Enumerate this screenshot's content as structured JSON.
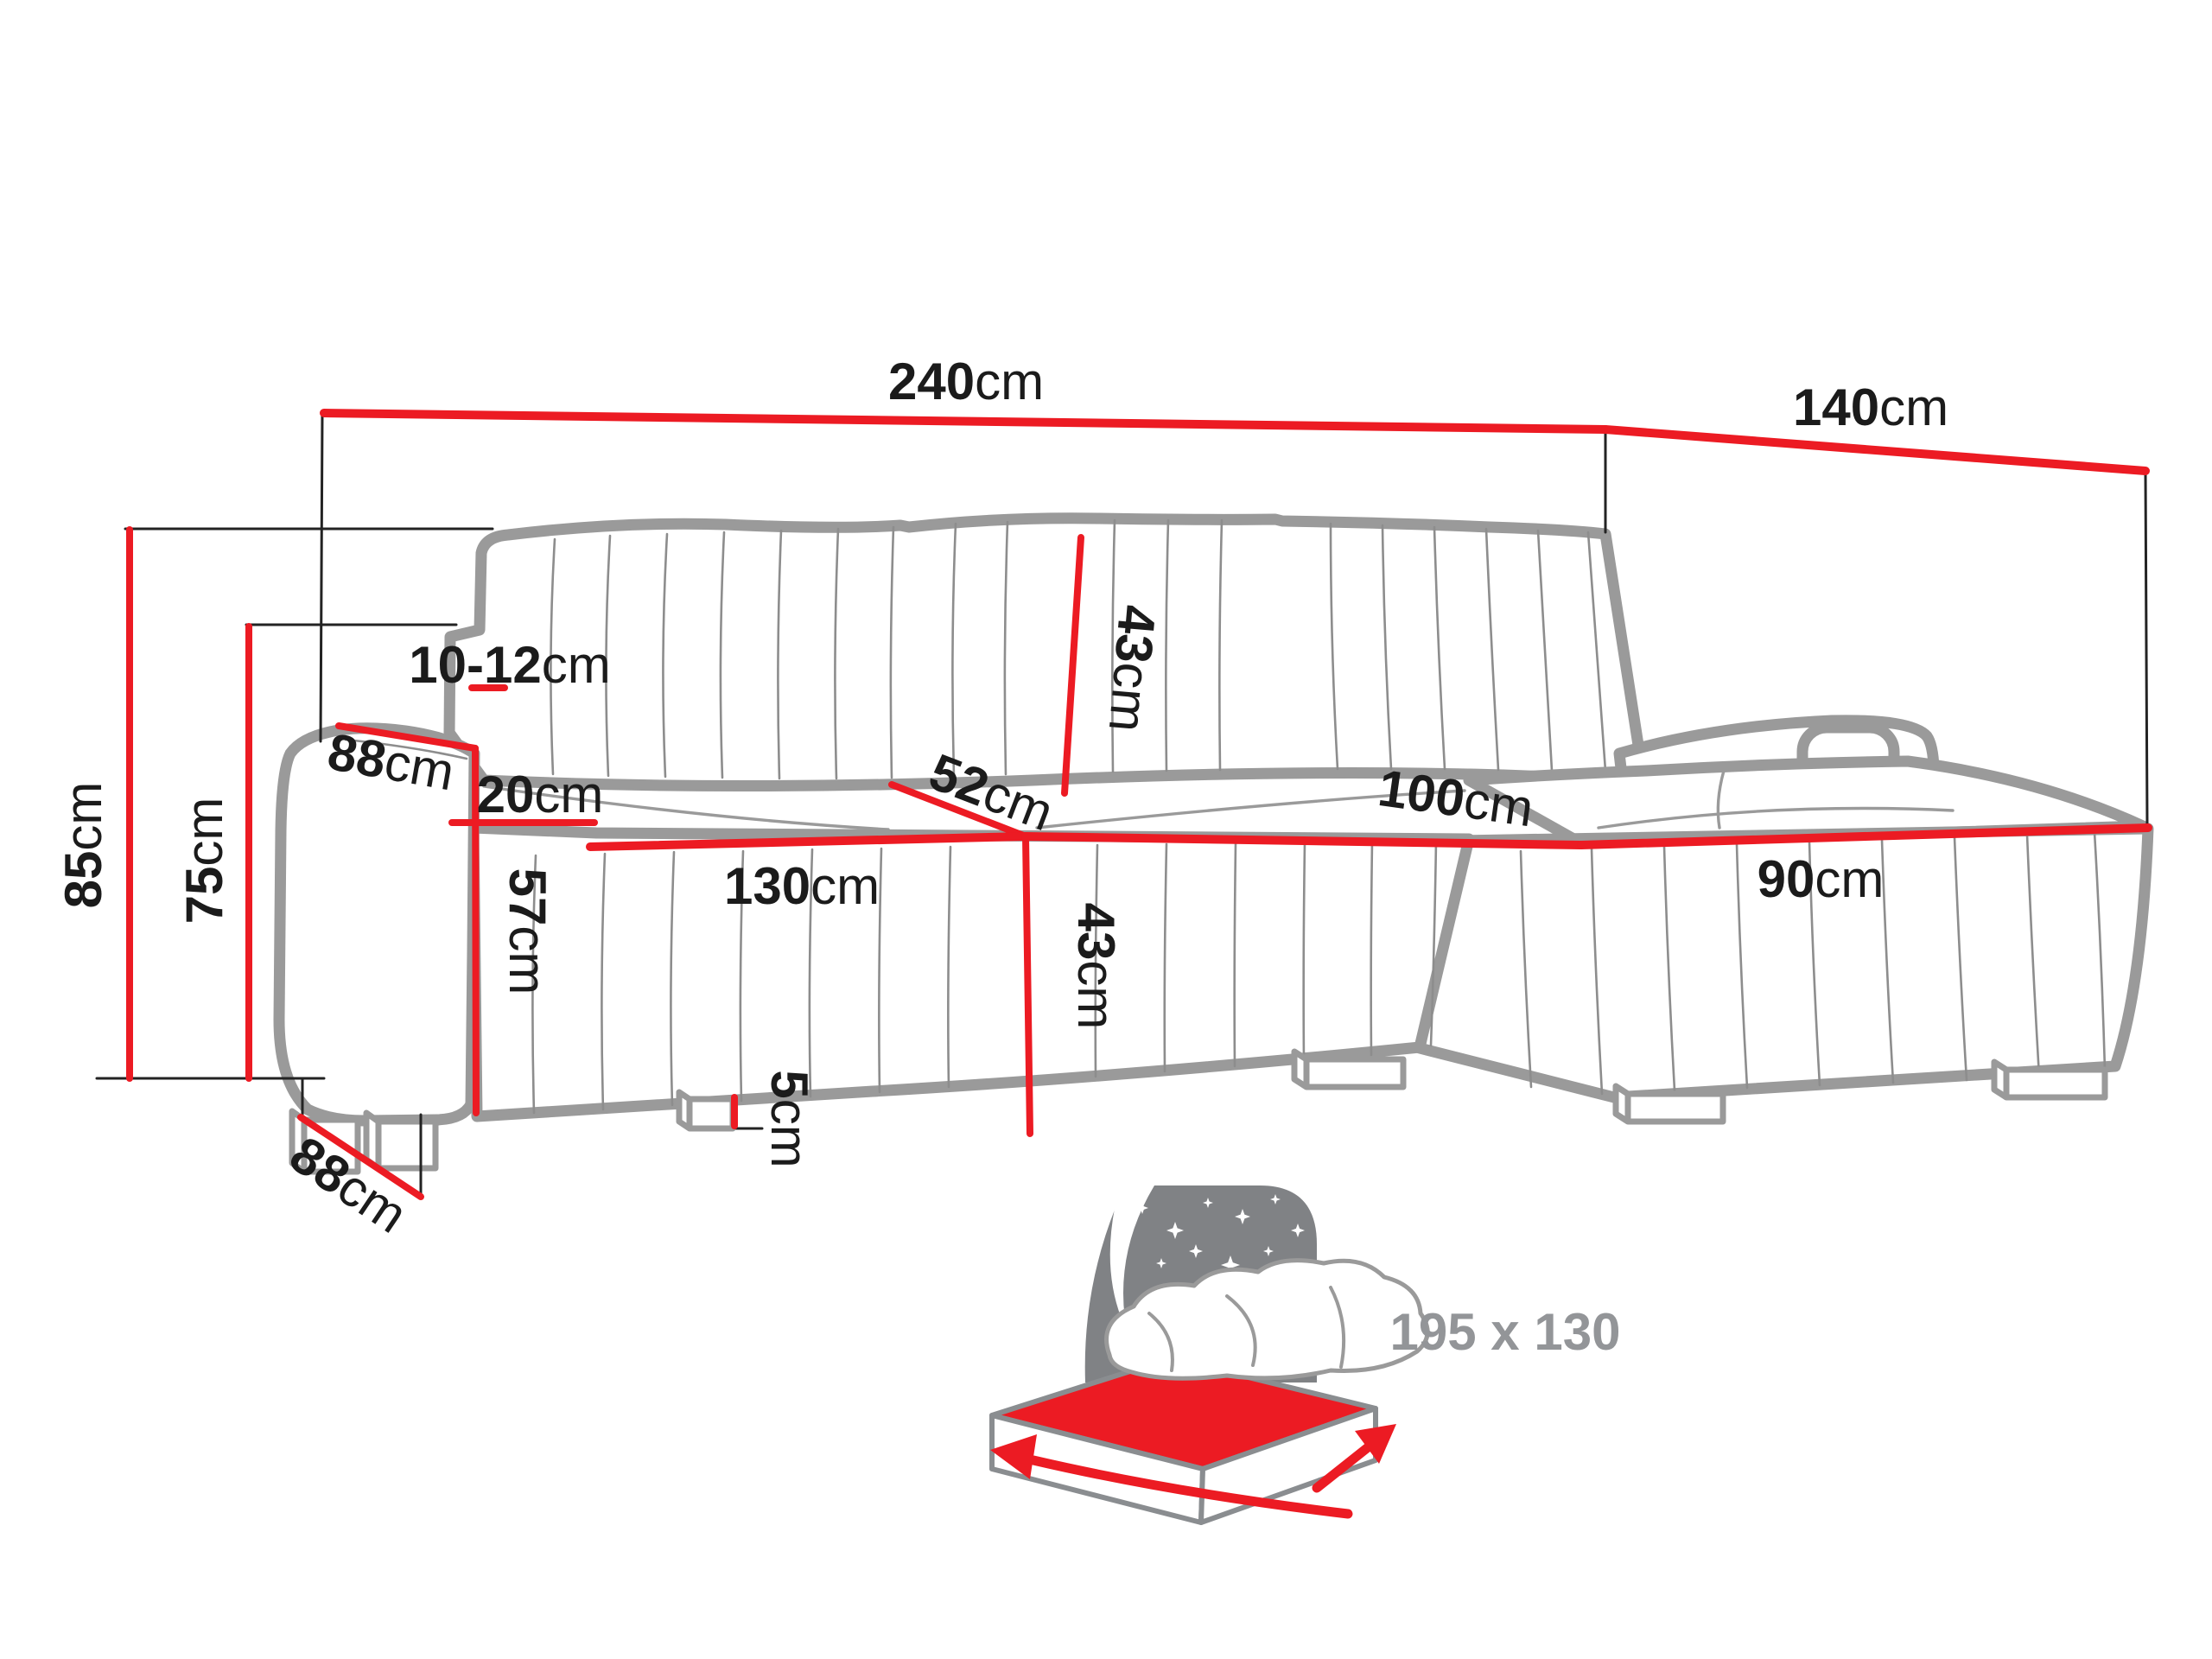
{
  "diagram": {
    "title": "corner-sofa-dimensions",
    "colors": {
      "dimension_red": "#ec1b23",
      "sofa_outline_gray": "#9a9a9a",
      "text_black": "#1b1b1b",
      "icon_panel_gray": "#808285",
      "icon_text_gray": "#939598"
    },
    "dimensions": {
      "overall_width": {
        "value": "240",
        "unit": "cm"
      },
      "return_depth": {
        "value": "140",
        "unit": "cm"
      },
      "overall_height": {
        "value": "85",
        "unit": "cm"
      },
      "backrest_height": {
        "value": "75",
        "unit": "cm"
      },
      "headrest_adjustment": {
        "value": "10-12",
        "unit": "cm"
      },
      "armrest_depth_top": {
        "value": "88",
        "unit": "cm"
      },
      "armrest_width": {
        "value": "20",
        "unit": "cm"
      },
      "seat_front_height": {
        "value": "57",
        "unit": "cm"
      },
      "seat_length": {
        "value": "130",
        "unit": "cm"
      },
      "seat_depth": {
        "value": "52",
        "unit": "cm"
      },
      "backrest_cushion": {
        "value": "43",
        "unit": "cm"
      },
      "seat_height": {
        "value": "43",
        "unit": "cm"
      },
      "leg_height": {
        "value": "5",
        "unit": "cm"
      },
      "chaise_length": {
        "value": "100",
        "unit": "cm"
      },
      "chaise_width": {
        "value": "90",
        "unit": "cm"
      },
      "base_depth": {
        "value": "88",
        "unit": "cm"
      }
    },
    "sleeping_area": {
      "size_label": "195 x 130"
    }
  }
}
